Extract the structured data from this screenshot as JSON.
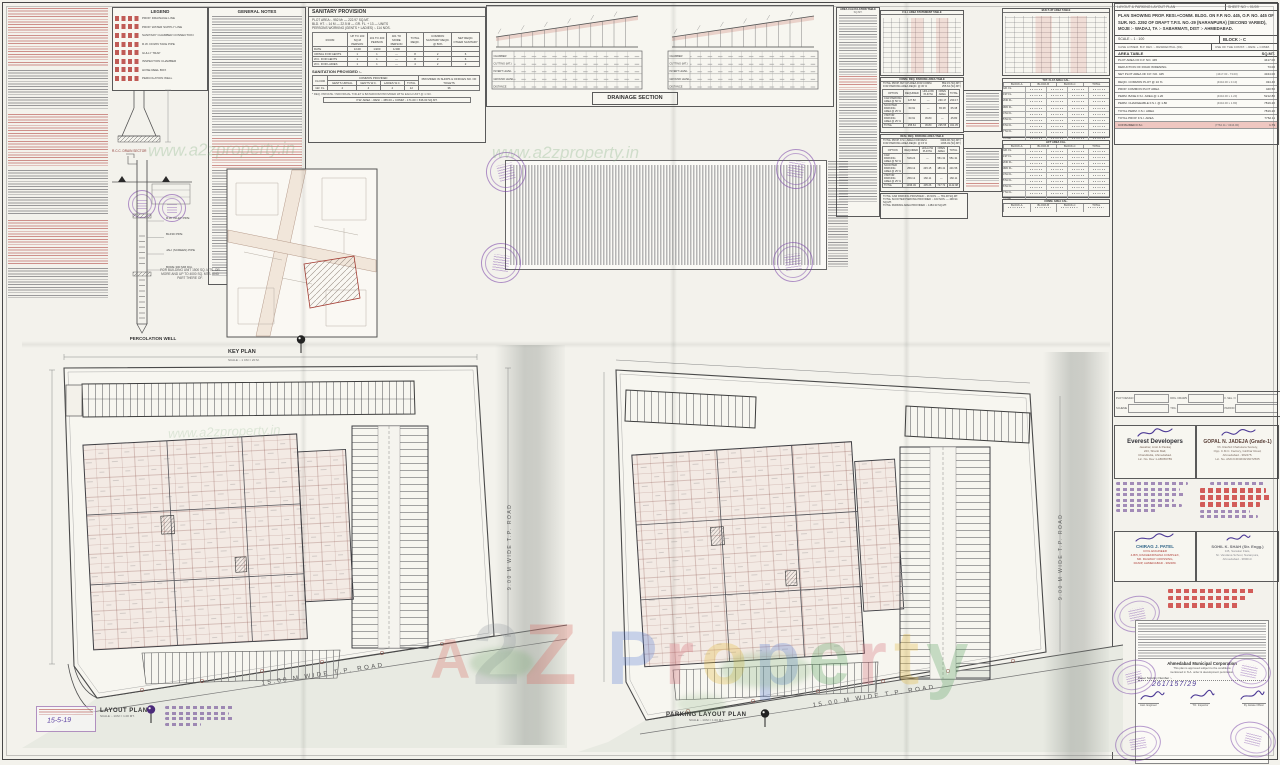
{
  "watermark": {
    "brand": [
      {
        "ch": "A",
        "color": "#d86a62"
      },
      {
        "ch": "2",
        "color": "#9aa0a6"
      },
      {
        "ch": "Z",
        "color": "#d86a62"
      }
    ],
    "property": [
      {
        "ch": "P",
        "color": "#5b7fd6"
      },
      {
        "ch": "r",
        "color": "#d66a76"
      },
      {
        "ch": "o",
        "color": "#e5b93c"
      },
      {
        "ch": "p",
        "color": "#5b7fd6"
      },
      {
        "ch": "e",
        "color": "#58a15f"
      },
      {
        "ch": "r",
        "color": "#d66a76"
      },
      {
        "ch": "t",
        "color": "#e5b93c"
      },
      {
        "ch": "y",
        "color": "#58a15f"
      }
    ],
    "url": "www.a2zproperty.in"
  },
  "title_block": {
    "plan_type": "LAYOUT & PARKING LAYOUT PLAN",
    "sheet_no": "SHEET NO :- 01/09",
    "description": "PLAN SHOWING PROP. RESI.+COMM. BLDG. ON F.P. NO. 445, O.P. NO. 445 OF SUR. NO. 2292 OF DRAFT T.P.S. NO.-29 (NARANPURA) (SECOND VARIED), MOJE :- WADAJ, TA :- SABARMATI, DIST :- AHMEDABAD.",
    "scale_label": "SCALE :- 1 : 100",
    "block_label": "BLOCK :- C",
    "case_left": "CASE A PREM. B.P. DEV. :- RESIDENTIAL (R1)",
    "case_right": "USE OF THE CONST. :- RESI. + COMM.",
    "area_table": {
      "title": "AREA TABLE",
      "unit": "SQ.MT.",
      "rows": [
        {
          "label": "PLOT AREA OF F.P. NO. 445",
          "calc": "",
          "value": "4417.00"
        },
        {
          "label": "DEDUCTION OF ROAD WIDENING",
          "calc": "",
          "value": "73.00"
        },
        {
          "label": "NET PLOT AREA OF F.P. NO. 445",
          "calc": "(4417.00 - 73.00)",
          "value": "4344.00"
        },
        {
          "label": "REQD. COMMON PLOT @ 10 %",
          "calc": "(4344.00 x 0.10)",
          "value": "434.40"
        },
        {
          "label": "PROP. COMMON PLOT AREA",
          "calc": "",
          "value": "440.50"
        },
        {
          "label": "PERM. BASE F.S.I. AREA @ 1.20",
          "calc": "(4344.00 x 1.20)",
          "value": "5212.80"
        },
        {
          "label": "PERM. CHARGEABLE F.S.I. @ 1.80",
          "calc": "(4344.00 x 1.80)",
          "value": "7819.20"
        },
        {
          "label": "TOTAL PERM. F.S.I. AREA",
          "calc": "",
          "value": "7819.20"
        },
        {
          "label": "TOTAL PROP. F.S.I. AREA",
          "calc": "",
          "value": "7762.11"
        },
        {
          "label": "CONSUMED F.S.I.",
          "calc": "(7762.11 / 4344.00)",
          "value": "1.79",
          "bg": "rgba(224,138,128,0.45)"
        }
      ]
    }
  },
  "legend": {
    "title": "LEGEND",
    "items": [
      {
        "label": "PROP. DRAINAGE LINE"
      },
      {
        "label": "PROP. WATER SUPPLY LINE"
      },
      {
        "label": "SANITARY CHAMBER CONNECTION"
      },
      {
        "label": "R.W. DOWN TAKE PIPE"
      },
      {
        "label": "GULLY TRAP"
      },
      {
        "label": "INSPECTION CHAMBER"
      },
      {
        "label": "HOSE REEL BOX"
      },
      {
        "label": "PERCOLATION WELL"
      }
    ]
  },
  "general_notes": {
    "title": "GENERAL NOTES"
  },
  "sanitary": {
    "title": "SANITARY PROVISION",
    "info_lines": [
      "PLOT AREA :- 952 M² — 222.97 SQ.MT.",
      "BLD. HT. :- 14 M — 22.5 M — GR. FL. + 13 — UNITS",
      "PERSONS WORKING (GENTS + LADIES) :- 114 NOS."
    ],
    "main_table": {
      "headers": [
        "ROOM",
        "UP TO 100 SQ.M PERSON",
        "101 TO 400 PERSON",
        "401 TO MORE PERSON",
        "TOTAL REQD.",
        "COMMON SANITARY REQD. @ 50%",
        "NET REQD. OTHER SANITARY"
      ],
      "rows": [
        [
          "RATE",
          "1/100",
          "1/200",
          "1/400",
          "",
          "",
          ""
        ],
        [
          "URINAL FOR GENTS",
          "1",
          "1",
          "—",
          "8",
          "2",
          "6"
        ],
        [
          "W.C. FOR GENTS",
          "1",
          "1",
          "—",
          "8",
          "2",
          "6"
        ],
        [
          "W.C. FOR LADIES",
          "1",
          "1",
          "—",
          "4",
          "2",
          "2"
        ]
      ]
    },
    "provided_title": "SANITATION PROVIDED :-",
    "provided_group": "COMMON PROVIDED",
    "provided_cols": [
      "FLOOR",
      "GENTS URINAL",
      "GENTS W.C.",
      "LADIES W.C.",
      "TOTAL",
      "PROVIDED IN SHOPS & OFFICES NO. OF TOILETS"
    ],
    "provided_row": [
      "GR. FL.",
      "4",
      "4",
      "4",
      "12",
      "36"
    ],
    "note": "* REQ. PRIVATE / INDIVIDUAL TOILET & BATHROOM PROVIDED WITH EACH UNIT @ 1 NO.",
    "boxed_note": "P.W. AREA :- RESI :- 465.00 + COMM :- 171.00 = 636.00 SQ.MT."
  },
  "drainage": {
    "title": "DRAINAGE SECTION",
    "row_labels": [
      "CHAMBER",
      "CUTTING (MT.)",
      "INVERT LEVEL",
      "GROUND LEVEL",
      "DISTANCE"
    ]
  },
  "area_calc": {
    "title": "AREA CALCULATION TABLE",
    "unit": "SQ.MT."
  },
  "fsi_table": {
    "title": "F.S.I. AREA STATEMENT TABLE"
  },
  "comm_parking": {
    "title": "COMM. REQ. PARKING AREA TABLE",
    "bullets": [
      {
        "t": "TOTAL PROP. BLT.UP AREA FOR COMM.",
        "v": "852.15 (SQ.MT.)"
      },
      {
        "t": "FOR PARKING AREA REQD. @ 30 %",
        "v": "255.64 (SQ.MT.)"
      }
    ],
    "headers": [
      "OPTION",
      "REQUIRED",
      "HOLLOW PLINTH",
      "OPEN AREA",
      "TOTAL"
    ],
    "rows": [
      [
        "CAR PARKING AREA @ 50 %",
        "127.82",
        "—",
        "230.17",
        "230.17"
      ],
      [
        "SCOOTER PARKING AREA @ 25 %",
        "63.91",
        "—",
        "65.38",
        "65.38"
      ],
      [
        "VISITOR PARKING AREA @ 25 %",
        "63.91",
        "45.80",
        "—",
        "45.80"
      ],
      [
        "TOTAL",
        "255.64",
        "45.80",
        "295.55",
        "341.35"
      ]
    ]
  },
  "resi_parking": {
    "title": "RESI. REQ. PARKING AREA TABLE",
    "bullets": [
      {
        "t": "TOTAL PROP. F.S.I. AREA FOR RESI.",
        "v": "6909.96 (SQ.MT.)"
      },
      {
        "t": "FOR PARKING AREA REQD. @ 15 %",
        "v": "1036.49 (SQ.MT.)"
      }
    ],
    "headers": [
      "OPTION",
      "REQUIRED",
      "HOLLOW PLINTH",
      "OPEN AREA",
      "TOTAL"
    ],
    "rows": [
      [
        "CAR PARKING AREA @ 50 %",
        "518.24",
        "—",
        "551.31",
        "551.31"
      ],
      [
        "SCOOTER PARKING AREA @ 25 %",
        "259.12",
        "245.15",
        "186.41",
        "431.56"
      ],
      [
        "VISITOR PARKING AREA @ 25 %",
        "259.12",
        "160.11",
        "—",
        "160.11"
      ],
      [
        "TOTAL",
        "1036.49",
        "405.26",
        "737.72",
        "1142.98"
      ]
    ]
  },
  "total_parking": {
    "lines": [
      "TOTAL CAR PARKING PROVIDED :- 26 NOS. — 781.48 SQ.MT.",
      "TOTAL SCOOTER PARKING PROVIDED :- 163 NOS. — 496.94 SQ.MT.",
      "TOTAL PARKING AREA PROVIDED :- 1484.33 SQ.MT."
    ]
  },
  "block_tables": {
    "bua_title": "BUILT-UP AREA TABLE",
    "flat_title": "TOT. FLAT AREA CAL.",
    "lift_title": "LIFT AREA CAL.",
    "comm_title": "COMM. AREA CAL.",
    "cols": [
      "BLOCK-A",
      "BLOCK-B",
      "BLOCK-C",
      "TOTAL"
    ],
    "floors": [
      "GR. FL.",
      "1ST FL.",
      "2ND FL.",
      "3RD FL.",
      "4TH FL.",
      "5TH FL.",
      "6TH FL.",
      "7TH FL.",
      "TOTAL"
    ]
  },
  "key_plan": {
    "title": "KEY PLAN",
    "scale": "SCALE :- 1 CM = 20 M."
  },
  "percolation": {
    "detail_label": "R.C.C. DRAIN SECTOR",
    "title": "PERCOLATION WELL",
    "leaders": [
      "R.W. INLET PIPE",
      "BLIND PIPE",
      "JALI (SCREEN) PIPE",
      "BORE 300 MM DIA."
    ],
    "note": [
      "FOR BUILDING UNIT 1500 SQ. MTS. OR",
      "MORE AND UP TO 4000 SQ. MTS. AND",
      "PART THERE OF."
    ]
  },
  "plans": {
    "left": {
      "title": "LAYOUT PLAN",
      "scale": "SCALE :- 1CM = 1.00 MT.",
      "road": "15.00 M WIDE T.P. ROAD",
      "road_side": "9.00 M WIDE T.P. ROAD"
    },
    "right": {
      "title": "PARKING LAYOUT PLAN",
      "scale": "SCALE :- 1CM = 1.00 MT.",
      "road": "15.00 M WIDE T.P. ROAD",
      "road_side": "9.00 M WIDE T.P. ROAD"
    }
  },
  "right_panel": {
    "info_labels": [
      "PLOT DESIGN",
      "DRG. DRAWN",
      "F. SEL. N",
      "SCHEME",
      "TRG.",
      "PERIOD"
    ],
    "developer": {
      "name": "Everest Developers",
      "lines": [
        "Jawahar, Amit & Pankaj",
        "223, Shanti Mall,",
        "Chandlodia, Ahmedabad.",
        "Lic. No. Dev 1-AB456789"
      ]
    },
    "architect": {
      "name": "GOPAL N. JADEJA (Grade-1)",
      "lines": [
        "Vh. Rashid Chabutara Society,",
        "Opp. C.M.C. Factory, Girdhar Road,",
        "Ahmedabad - 382475.",
        "Lic. No. AMC/CR/4639/16072565"
      ]
    },
    "engineer1": {
      "name": "CHIRAG J. PATEL",
      "lines": [
        "CIVIL ENGINEER",
        "4-B/5, RADHEKRISHNA COMPLEX,",
        "NR. RAILWAY CROSSING,",
        "RANIP, AHMEDABAD - 382480."
      ]
    },
    "engineer2": {
      "name": "SOHIL K. SHAH (Str. Engg.)",
      "lines": [
        "3-B, Sanskar Flats,",
        "Nr. Vandana School, Naranpura,",
        "Ahmedabad - 380013."
      ]
    },
    "amc": {
      "org": "Ahmedabad Municipal Corporation",
      "line1": "This plan is approved subject to the conditions",
      "line2": "mentioned in N.A. order & development permission.",
      "scrutiny_label": "Paper Scrutiny Number :-",
      "case_no": "261/157/29",
      "sign_labels": [
        "Asst. Engineer",
        "T.D. Inspector",
        "Dy. Estate Officer"
      ]
    },
    "date_stamp": "15-5-19"
  }
}
